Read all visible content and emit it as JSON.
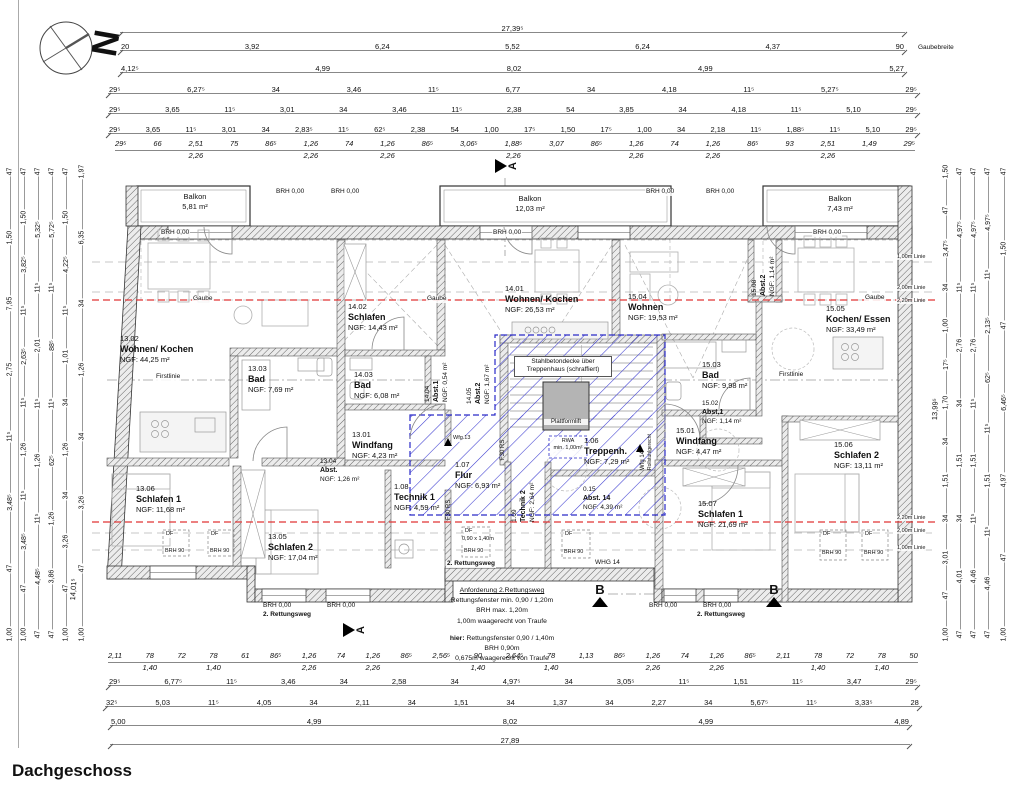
{
  "title": "Dachgeschoss",
  "markers": {
    "north": "N",
    "section_a": "A",
    "section_b": "B"
  },
  "labels": {
    "brh000": "BRH 0,00",
    "gaube": "Gaube",
    "firstlinie": "Firstlinie",
    "gaubebreite": "Gaubebreite",
    "stahlbeton_1": "Stahlbetondecke über",
    "stahlbeton_2": "Treppenhaus (schraffiert)",
    "plattformlift": "Plattformlift",
    "rwa_1": "RWA",
    "rwa_2": "min. 1,00m²",
    "df": "DF",
    "brh90": "BRH 90",
    "df_size": "0,90 x 1,40m",
    "rettungsweg": "2. Rettungsweg",
    "whg14": "WHG 14",
    "wfg13": "Wfg.13",
    "wfg14": "Wfg 14",
    "rollstuhl": "Rollstuhlgerecht",
    "f30rs": "F30 RS",
    "linie_100": "1,00m Linie",
    "linie_200": "2,00m Linie",
    "linie_220": "2,20m Linie",
    "dim_left_diag": "14,01⁵",
    "dim_right_diag": "13,99⁵"
  },
  "balconies": {
    "b1": {
      "name": "Balkon",
      "area": "5,81 m²"
    },
    "b2": {
      "name": "Balkon",
      "area": "12,03 m²"
    },
    "b3": {
      "name": "Balkon",
      "area": "7,43 m²"
    }
  },
  "rooms": {
    "w1301": {
      "num": "13.01",
      "name": "Windfang",
      "area": "NGF: 4,23 m²"
    },
    "w1302": {
      "num": "13.02",
      "name": "Wohnen/ Kochen",
      "area": "NGF: 44,25 m²"
    },
    "w1303": {
      "num": "13.03",
      "name": "Bad",
      "area": "NGF: 7,69 m²"
    },
    "w1304": {
      "num": "13.04",
      "name": "Abst.",
      "area": "NGF: 1,26 m²"
    },
    "w1305": {
      "num": "13.05",
      "name": "Schlafen 2",
      "area": "NGF: 17,04 m²"
    },
    "w1306": {
      "num": "13.06",
      "name": "Schlafen 1",
      "area": "NGF: 11,68 m²"
    },
    "w1401": {
      "num": "14.01",
      "name": "Wohnen/ Kochen",
      "area": "NGF: 26,53 m²"
    },
    "w1402": {
      "num": "14.02",
      "name": "Schlafen",
      "area": "NGF: 14,43 m²"
    },
    "w1403": {
      "num": "14.03",
      "name": "Bad",
      "area": "NGF: 6,08 m²"
    },
    "w1404": {
      "num": "14.04",
      "name": "Abst.1",
      "area": "NGF: 0,54 m²"
    },
    "w1405": {
      "num": "14.05",
      "name": "Abst.2",
      "area": "NGF: 1,67 m²"
    },
    "w1501": {
      "num": "15.01",
      "name": "Windfang",
      "area": "NGF: 4,47 m²"
    },
    "w1502": {
      "num": "15.02",
      "name": "Abst.1",
      "area": "NGF: 1,14 m²"
    },
    "w1503": {
      "num": "15.03",
      "name": "Bad",
      "area": "NGF: 9,98 m²"
    },
    "w1504": {
      "num": "15.04",
      "name": "Wohnen",
      "area": "NGF: 19,53 m²"
    },
    "w1505": {
      "num": "15.05",
      "name": "Kochen/ Essen",
      "area": "NGF: 33,49 m²"
    },
    "w1506": {
      "num": "15.06",
      "name": "Schlafen 2",
      "area": "NGF: 13,11 m²"
    },
    "w1507": {
      "num": "15.07",
      "name": "Schlafen 1",
      "area": "NGF: 21,69 m²"
    },
    "w1508": {
      "num": "15.08",
      "name": "Abst.2",
      "area": "NGF: 1,14 m²"
    },
    "t106": {
      "num": "1.06",
      "name": "Treppenh.",
      "area": "NGF: 7,29 m²"
    },
    "t107": {
      "num": "1.07",
      "name": "Flur",
      "area": "NGF: 6,93 m²"
    },
    "t108": {
      "num": "1.08",
      "name": "Technik 1",
      "area": "NGF: 4,59 m²"
    },
    "t109": {
      "num": "1.09",
      "name": "Technik 2",
      "area": "NGF: 2,64 m²"
    },
    "a015": {
      "num": "0.15",
      "name": "Abst. 14",
      "area": "NGF: 4,39 m²"
    }
  },
  "annotation": {
    "l1": "Anforderung 2.Rettungsweg",
    "l2": "Rettungsfenster min. 0,90 / 1,20m",
    "l3": "BRH max. 1,20m",
    "l4": "1,00m waagerecht von Traufe",
    "hier_label": "hier:",
    "hier_text": " Rettungsfenster 0,90 / 1,40m",
    "l6": "BRH 0,90m",
    "l7": "0,675m waagerecht von Traufe"
  },
  "dims": {
    "t1": [
      "27,39⁵"
    ],
    "t2": [
      "20",
      "3,92",
      "6,24",
      "5,52",
      "6,24",
      "4,37",
      "90"
    ],
    "t3": [
      "4,12⁵",
      "4,99",
      "8,02",
      "4,99",
      "5,27"
    ],
    "t4": [
      "29⁵",
      "6,27⁵",
      "34",
      "3,46",
      "11⁵",
      "6,77",
      "34",
      "4,18",
      "11⁵",
      "5,27⁵",
      "29⁵"
    ],
    "t5": [
      "29⁵",
      "3,65",
      "11⁵",
      "3,01",
      "34",
      "3,46",
      "11⁵",
      "2,38",
      "54",
      "3,85",
      "34",
      "4,18",
      "11⁵",
      "5,10",
      "29⁵"
    ],
    "t6": [
      "29⁵",
      "3,65",
      "11⁵",
      "3,01",
      "34",
      "2,83⁵",
      "11⁵",
      "62⁵",
      "2,38",
      "54",
      "1,00",
      "17⁵",
      "1,50",
      "17⁵",
      "1,00",
      "34",
      "2,18",
      "11⁵",
      "1,88⁵",
      "11⁵",
      "5,10",
      "29⁵"
    ],
    "t7": [
      {
        "a": "29⁵",
        "b": ""
      },
      {
        "a": "66",
        "b": ""
      },
      {
        "a": "2,51",
        "b": "2,26"
      },
      {
        "a": "75",
        "b": ""
      },
      {
        "a": "86⁵",
        "b": ""
      },
      {
        "a": "1,26",
        "b": "2,26"
      },
      {
        "a": "74",
        "b": ""
      },
      {
        "a": "1,26",
        "b": "2,26"
      },
      {
        "a": "86⁵",
        "b": ""
      },
      {
        "a": "3,06⁵",
        "b": ""
      },
      {
        "a": "1,88⁵",
        "b": "2,26"
      },
      {
        "a": "3,07",
        "b": ""
      },
      {
        "a": "86⁵",
        "b": ""
      },
      {
        "a": "1,26",
        "b": "2,26"
      },
      {
        "a": "74",
        "b": ""
      },
      {
        "a": "1,26",
        "b": "2,26"
      },
      {
        "a": "86⁵",
        "b": ""
      },
      {
        "a": "93",
        "b": ""
      },
      {
        "a": "2,51",
        "b": "2,26"
      },
      {
        "a": "1,49",
        "b": ""
      },
      {
        "a": "29⁵",
        "b": ""
      }
    ],
    "b1": [
      {
        "a": "2,11",
        "b": ""
      },
      {
        "a": "78",
        "b": "1,40"
      },
      {
        "a": "72",
        "b": ""
      },
      {
        "a": "78",
        "b": "1,40"
      },
      {
        "a": "61",
        "b": ""
      },
      {
        "a": "86⁵",
        "b": ""
      },
      {
        "a": "1,26",
        "b": "2,26"
      },
      {
        "a": "74",
        "b": ""
      },
      {
        "a": "1,26",
        "b": "2,26"
      },
      {
        "a": "86⁵",
        "b": ""
      },
      {
        "a": "2,56⁵",
        "b": ""
      },
      {
        "a": "90",
        "b": "1,40"
      },
      {
        "a": "2,64⁵",
        "b": ""
      },
      {
        "a": "78",
        "b": "1,40"
      },
      {
        "a": "1,13",
        "b": ""
      },
      {
        "a": "86⁵",
        "b": ""
      },
      {
        "a": "1,26",
        "b": "2,26"
      },
      {
        "a": "74",
        "b": ""
      },
      {
        "a": "1,26",
        "b": "2,26"
      },
      {
        "a": "86⁵",
        "b": ""
      },
      {
        "a": "2,11",
        "b": ""
      },
      {
        "a": "78",
        "b": "1,40"
      },
      {
        "a": "72",
        "b": ""
      },
      {
        "a": "78",
        "b": "1,40"
      },
      {
        "a": "50",
        "b": ""
      }
    ],
    "b2": [
      "29⁵",
      "6,77⁵",
      "11⁵",
      "3,46",
      "34",
      "2,58",
      "34",
      "4,97⁵",
      "34",
      "3,05⁵",
      "11⁵",
      "1,51",
      "11⁵",
      "3,47",
      "29⁵"
    ],
    "b3": [
      "32⁵",
      "5,03",
      "11⁵",
      "4,05",
      "34",
      "2,11",
      "34",
      "1,51",
      "34",
      "1,37",
      "34",
      "2,27",
      "34",
      "5,67⁵",
      "11⁵",
      "3,33⁵",
      "28"
    ],
    "b4": [
      "5,00",
      "4,99",
      "8,02",
      "4,99",
      "4,89"
    ],
    "b5": [
      "27,89"
    ],
    "l1": [
      "47",
      "1,50",
      "7,95",
      "2,75",
      "11⁵",
      "3,48⁵",
      "47",
      "1,00"
    ],
    "l2": [
      "47",
      "1,50",
      "3,82⁵",
      "11⁵",
      "2,63⁵",
      "11⁵",
      "1,26",
      "11⁵",
      "3,48⁵",
      "47",
      "1,00"
    ],
    "l3": [
      "47",
      "5,32⁵",
      "11⁵",
      "2,01",
      "11⁵",
      "1,26",
      "11⁵",
      "4,48⁵",
      "47"
    ],
    "l4": [
      "47",
      "5,72⁵",
      "11⁵",
      "88⁵",
      "11⁵",
      "62⁵",
      "1,26",
      "3,86",
      "47"
    ],
    "l5": [
      "47",
      "1,50",
      "4,22⁵",
      "11⁵",
      "1,01",
      "34",
      "1,26",
      "34",
      "3,26",
      "47",
      "1,00"
    ],
    "l6": [
      "1,97",
      "6,35",
      "34",
      "1,26",
      "34",
      "3,26",
      "47",
      "1,00"
    ],
    "r1": [
      "1,50",
      "47",
      "3,47⁵",
      "34",
      "1,00",
      "17⁵",
      "1,70",
      "34",
      "1,51",
      "34",
      "3,01",
      "47",
      "1,00"
    ],
    "r2": [
      "47",
      "4,97⁵",
      "11⁵",
      "2,76",
      "34",
      "1,51",
      "34",
      "4,01",
      "47"
    ],
    "r3": [
      "47",
      "4,97⁵",
      "11⁵",
      "2,76",
      "11⁵",
      "1,51",
      "11⁵",
      "4,46",
      "47"
    ],
    "r4": [
      "47",
      "4,97⁵",
      "11⁵",
      "2,13⁵",
      "62⁵",
      "11⁵",
      "1,51",
      "11⁵",
      "4,46",
      "47"
    ],
    "r5": [
      "47",
      "1,50",
      "47",
      "6,46⁵",
      "4,97",
      "47",
      "1,00"
    ]
  }
}
